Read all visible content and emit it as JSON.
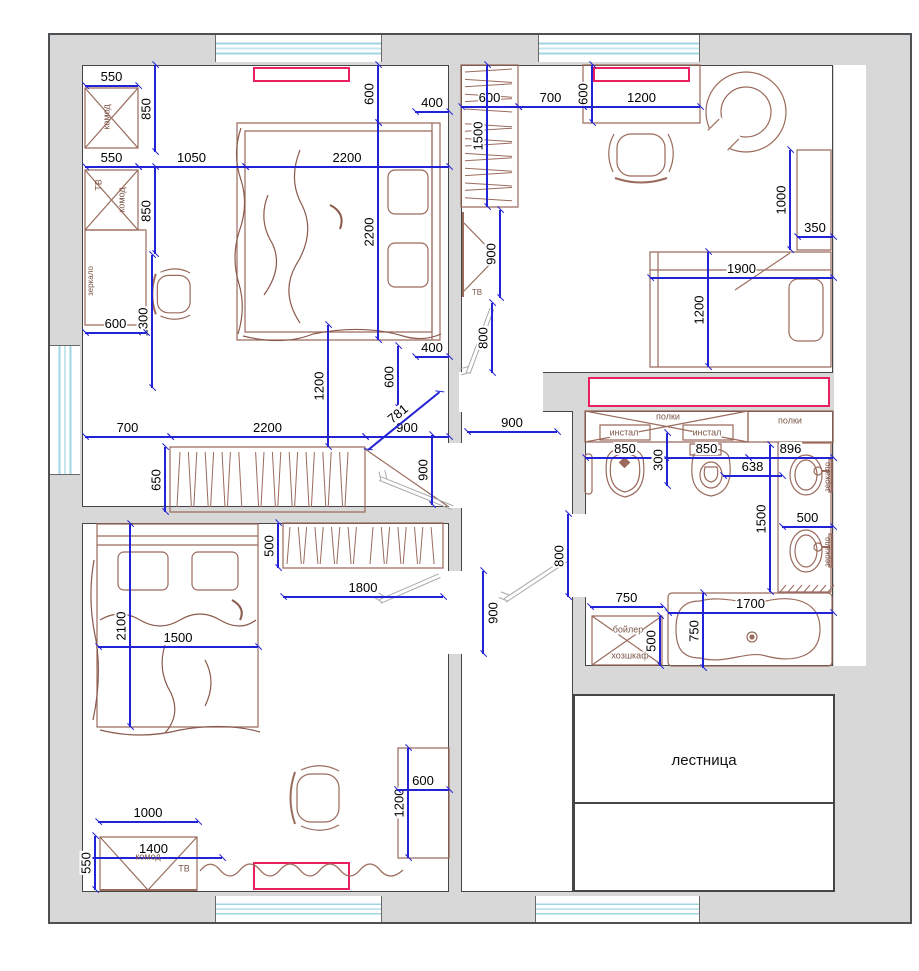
{
  "title": "floor-plan",
  "colors": {
    "dimension_blue": "#2323d6",
    "furniture_brown": "#9a6b5d",
    "wall_fill": "#d8d8d8",
    "wall_edge": "#4e5154",
    "accent_pink": "#ea1f5e",
    "window_glass": "#9fd4e2",
    "door_leaf_gray": "#a8a8a8",
    "text_black": "#000000",
    "label_brown": "#7d5748"
  },
  "labels": {
    "staircase": "лестница"
  },
  "furniture_labels": [
    {
      "text": "комод",
      "x": 107,
      "y": 117,
      "rot": -90,
      "size": 9
    },
    {
      "text": "ТВ",
      "x": 99,
      "y": 185,
      "rot": -90,
      "size": 9
    },
    {
      "text": "комод",
      "x": 122,
      "y": 200,
      "rot": -90,
      "size": 9
    },
    {
      "text": "зеркало",
      "x": 91,
      "y": 281,
      "rot": -90,
      "size": 8
    },
    {
      "text": "комод",
      "x": 148,
      "y": 857,
      "rot": 0,
      "size": 9
    },
    {
      "text": "ТВ",
      "x": 184,
      "y": 869,
      "rot": 0,
      "size": 9
    },
    {
      "text": "ТВ",
      "x": 477,
      "y": 293,
      "rot": 0,
      "size": 8
    },
    {
      "text": "полки",
      "x": 668,
      "y": 417,
      "rot": 0,
      "size": 9,
      "bg": true
    },
    {
      "text": "полки",
      "x": 790,
      "y": 421,
      "rot": 0,
      "size": 9
    },
    {
      "text": "инстал",
      "x": 624,
      "y": 433,
      "rot": 0,
      "size": 9,
      "bg": true
    },
    {
      "text": "инстал",
      "x": 707,
      "y": 433,
      "rot": 0,
      "size": 9,
      "bg": true
    },
    {
      "text": "бойлер",
      "x": 628,
      "y": 630,
      "rot": 0,
      "size": 9,
      "bg": true
    },
    {
      "text": "хозшкаф",
      "x": 630,
      "y": 656,
      "rot": 0,
      "size": 9,
      "bg": true
    },
    {
      "text": "зеркало",
      "x": 828,
      "y": 477,
      "rot": -90,
      "size": 8
    },
    {
      "text": "зеркало",
      "x": 828,
      "y": 552,
      "rot": -90,
      "size": 8
    }
  ],
  "dimensions": [
    {
      "t": "550",
      "o": "h",
      "x": 85,
      "y": 86,
      "len": 53
    },
    {
      "t": "850",
      "o": "v",
      "x": 155,
      "y": 65,
      "len": 87
    },
    {
      "t": "550",
      "o": "h",
      "x": 85,
      "y": 167,
      "len": 53
    },
    {
      "t": "1050",
      "o": "h",
      "x": 138,
      "y": 167,
      "len": 107
    },
    {
      "t": "2200",
      "o": "h",
      "x": 245,
      "y": 167,
      "len": 204
    },
    {
      "t": "850",
      "o": "v",
      "x": 155,
      "y": 167,
      "len": 87
    },
    {
      "t": "1300",
      "o": "v",
      "x": 152,
      "y": 255,
      "len": 133
    },
    {
      "t": "600",
      "o": "h",
      "x": 85,
      "y": 333,
      "len": 61
    },
    {
      "t": "600",
      "o": "v",
      "x": 378,
      "y": 65,
      "len": 58
    },
    {
      "t": "400",
      "o": "h",
      "x": 415,
      "y": 112,
      "len": 34
    },
    {
      "t": "2200",
      "o": "v",
      "x": 378,
      "y": 123,
      "len": 217
    },
    {
      "t": "400",
      "o": "h",
      "x": 415,
      "y": 357,
      "len": 34
    },
    {
      "t": "600",
      "o": "v",
      "x": 398,
      "y": 346,
      "len": 62
    },
    {
      "t": "1200",
      "o": "v",
      "x": 328,
      "y": 325,
      "len": 122
    },
    {
      "t": "700",
      "o": "h",
      "x": 85,
      "y": 437,
      "len": 85
    },
    {
      "t": "2200",
      "o": "h",
      "x": 170,
      "y": 437,
      "len": 195
    },
    {
      "t": "900",
      "o": "h",
      "x": 365,
      "y": 437,
      "len": 84
    },
    {
      "t": "650",
      "o": "v",
      "x": 165,
      "y": 447,
      "len": 65
    },
    {
      "t": "781",
      "o": "h",
      "rot": -39,
      "x": 368,
      "y": 450,
      "len": 92
    },
    {
      "t": "900",
      "o": "v",
      "x": 432,
      "y": 435,
      "len": 70
    },
    {
      "t": "2100",
      "o": "v",
      "x": 130,
      "y": 524,
      "len": 203
    },
    {
      "t": "1500",
      "o": "h",
      "x": 98,
      "y": 647,
      "len": 160
    },
    {
      "t": "500",
      "o": "v",
      "x": 278,
      "y": 523,
      "len": 45
    },
    {
      "t": "1800",
      "o": "h",
      "x": 283,
      "y": 597,
      "len": 160
    },
    {
      "t": "1200",
      "o": "v",
      "x": 408,
      "y": 748,
      "len": 110
    },
    {
      "t": "600",
      "o": "h",
      "x": 397,
      "y": 790,
      "len": 52
    },
    {
      "t": "1000",
      "o": "h",
      "x": 98,
      "y": 822,
      "len": 100
    },
    {
      "t": "1400",
      "o": "h",
      "x": 85,
      "y": 858,
      "len": 137
    },
    {
      "t": "550",
      "o": "v",
      "x": 95,
      "y": 836,
      "len": 54
    },
    {
      "t": "600",
      "o": "h",
      "x": 461,
      "y": 107,
      "len": 57
    },
    {
      "t": "700",
      "o": "h",
      "x": 518,
      "y": 107,
      "len": 65
    },
    {
      "t": "1200",
      "o": "h",
      "x": 583,
      "y": 107,
      "len": 117
    },
    {
      "t": "600",
      "o": "v",
      "x": 592,
      "y": 65,
      "len": 58
    },
    {
      "t": "1500",
      "o": "v",
      "x": 487,
      "y": 65,
      "len": 142
    },
    {
      "t": "900",
      "o": "v",
      "x": 500,
      "y": 210,
      "len": 88
    },
    {
      "t": "800",
      "o": "v",
      "x": 492,
      "y": 303,
      "len": 70
    },
    {
      "t": "1000",
      "o": "v",
      "x": 790,
      "y": 150,
      "len": 100
    },
    {
      "t": "350",
      "o": "h",
      "x": 797,
      "y": 237,
      "len": 36
    },
    {
      "t": "1900",
      "o": "h",
      "x": 650,
      "y": 278,
      "len": 183
    },
    {
      "t": "1200",
      "o": "v",
      "x": 708,
      "y": 252,
      "len": 115
    },
    {
      "t": "900",
      "o": "h",
      "x": 467,
      "y": 432,
      "len": 90
    },
    {
      "t": "900",
      "o": "v",
      "x": 483,
      "y": 571,
      "len": 83,
      "side": "r"
    },
    {
      "t": "800",
      "o": "v",
      "x": 568,
      "y": 514,
      "len": 83
    },
    {
      "t": "850",
      "o": "h",
      "x": 585,
      "y": 458,
      "len": 80
    },
    {
      "t": "850",
      "o": "h",
      "x": 665,
      "y": 458,
      "len": 83
    },
    {
      "t": "300",
      "o": "v",
      "x": 667,
      "y": 433,
      "len": 53
    },
    {
      "t": "638",
      "o": "h",
      "x": 723,
      "y": 476,
      "len": 59
    },
    {
      "t": "896",
      "o": "h",
      "x": 748,
      "y": 458,
      "len": 85
    },
    {
      "t": "1500",
      "o": "v",
      "x": 770,
      "y": 445,
      "len": 147
    },
    {
      "t": "500",
      "o": "h",
      "x": 782,
      "y": 527,
      "len": 51
    },
    {
      "t": "750",
      "o": "h",
      "x": 590,
      "y": 607,
      "len": 73
    },
    {
      "t": "500",
      "o": "v",
      "x": 660,
      "y": 616,
      "len": 50
    },
    {
      "t": "1700",
      "o": "h",
      "x": 668,
      "y": 613,
      "len": 165
    },
    {
      "t": "750",
      "o": "v",
      "x": 703,
      "y": 593,
      "len": 75
    }
  ]
}
